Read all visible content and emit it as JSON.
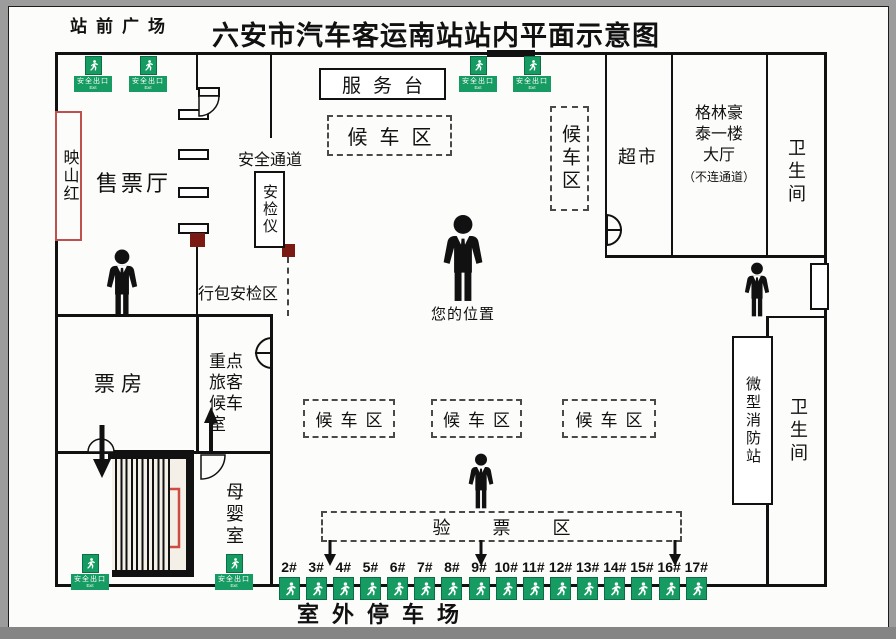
{
  "title": "六安市汽车客运南站站内平面示意图",
  "plaza": "站前广场",
  "exit_sign": {
    "label": "安全出口",
    "sub": "Exit"
  },
  "rooms": {
    "yingshanhong": "映山红",
    "ticket_hall": "售票厅",
    "service_desk": "服务台",
    "safety_passage": "安全通道",
    "security_scanner": "安检仪",
    "luggage_check_area": "行包安检区",
    "waiting_area": "候车区",
    "your_location": "您的位置",
    "supermarket": "超市",
    "greentree_hall": "格林豪泰一楼大厅",
    "greentree_note": "（不连通道）",
    "restroom": "卫生间",
    "ticket_office": "票房",
    "vip_waiting_room": "重点旅客候车室",
    "mother_baby_room": "母婴室",
    "mini_fire_station": "微型消防站",
    "ticket_check_area": "验票区",
    "outdoor_parking": "室外停车场"
  },
  "gates": [
    "2#",
    "3#",
    "4#",
    "5#",
    "6#",
    "7#",
    "8#",
    "9#",
    "10#",
    "11#",
    "12#",
    "13#",
    "14#",
    "15#",
    "16#",
    "17#"
  ],
  "colors": {
    "exit_green": "#169b62",
    "wall_black": "#111111",
    "dark_red": "#7a1a12",
    "bracket_red": "#cc4b42",
    "yingshanhong_border": "#c0504d",
    "frame_gray": "#9c9c9c"
  }
}
